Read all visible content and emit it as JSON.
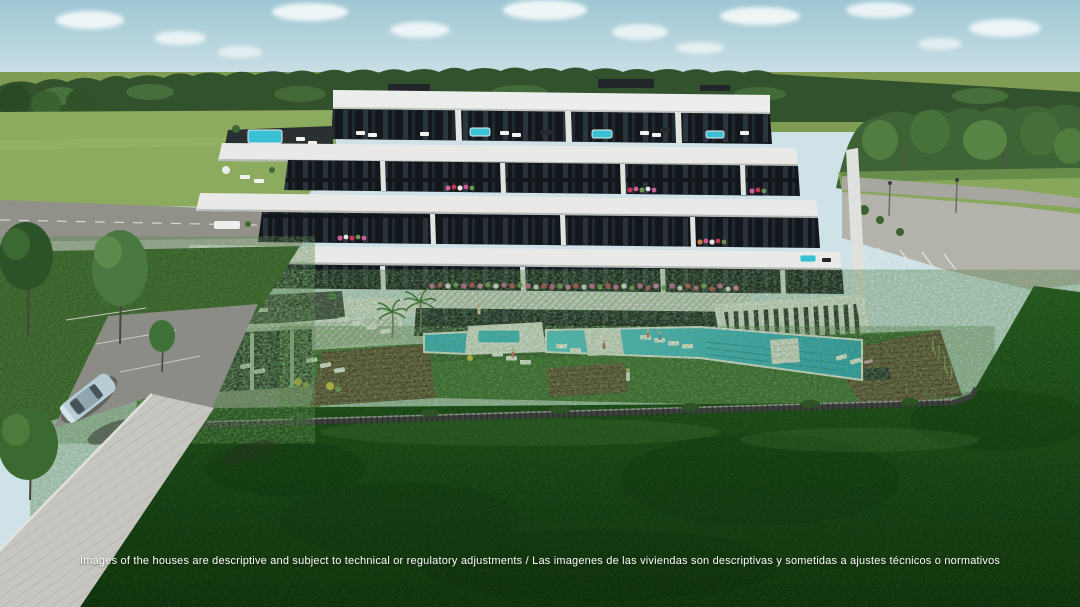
{
  "disclaimer": "Images of the houses are descriptive and subject to technical or regulatory adjustments / Las imagenes de las viviendas son descriptivas y sometidas a ajustes técnicos o normativos",
  "scene": {
    "type": "architectural-3d-render",
    "subject": "Aerial view of a modern terraced apartment building with communal pool area, lawns, forest backdrop, access roads, parking and a parked car"
  },
  "colors": {
    "sky": "#a9cdd9",
    "clouds": "#f6fafb",
    "forest": "#31522c",
    "field": "#8cab5e",
    "amenity_lawn": "#3f7634",
    "foreground_lawn": "#2a5f23",
    "building_white": "#e9eae7",
    "building_glass": "#14181c",
    "pool_water": "#35bccf",
    "wood_deck": "#5d4733",
    "road": "#97978f",
    "flowers_pink": "#d4619b",
    "flowers_red": "#c23a50",
    "car_body": "#b7ccd4"
  }
}
